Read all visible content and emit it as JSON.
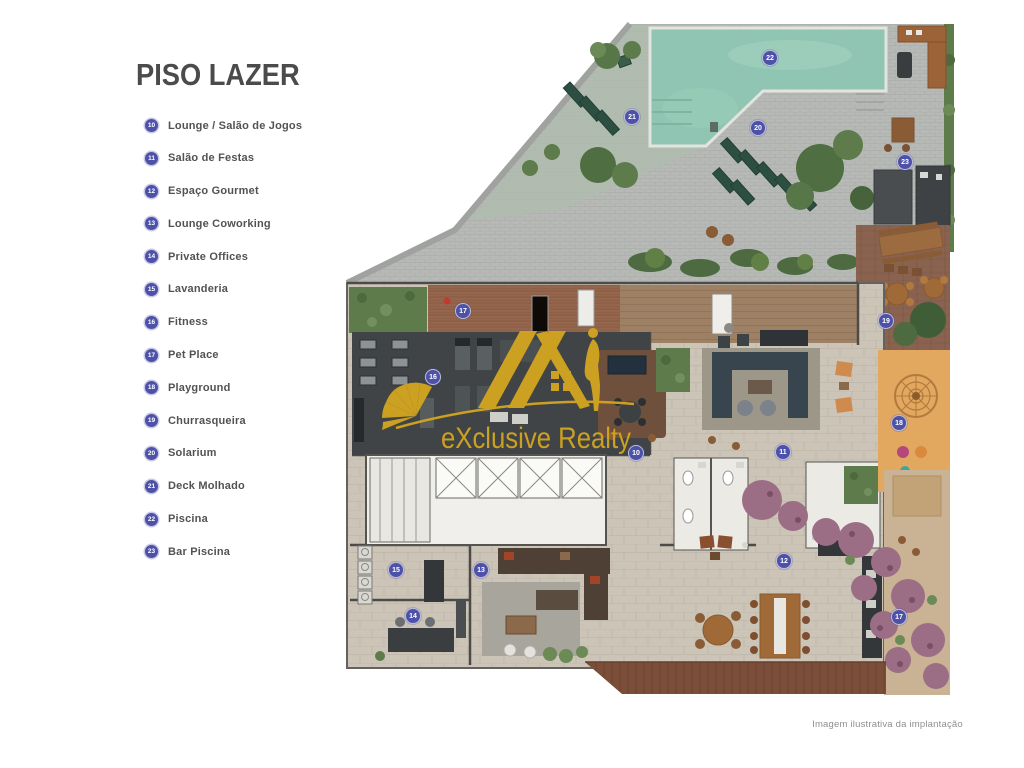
{
  "page": {
    "title": "PISO LAZER",
    "caption": "Imagem ilustrativa da implantação"
  },
  "watermark": {
    "brand": "eXclusive Realty"
  },
  "legend": {
    "items": [
      {
        "number": "10",
        "label": "Lounge / Salão de Jogos"
      },
      {
        "number": "11",
        "label": "Salão de Festas"
      },
      {
        "number": "12",
        "label": "Espaço Gourmet"
      },
      {
        "number": "13",
        "label": "Lounge Coworking"
      },
      {
        "number": "14",
        "label": "Private Offices"
      },
      {
        "number": "15",
        "label": "Lavanderia"
      },
      {
        "number": "16",
        "label": "Fitness"
      },
      {
        "number": "17",
        "label": "Pet Place"
      },
      {
        "number": "18",
        "label": "Playground"
      },
      {
        "number": "19",
        "label": "Churrasqueira"
      },
      {
        "number": "20",
        "label": "Solarium"
      },
      {
        "number": "21",
        "label": "Deck Molhado"
      },
      {
        "number": "22",
        "label": "Piscina"
      },
      {
        "number": "23",
        "label": "Bar Piscina"
      }
    ]
  },
  "plan": {
    "markers": [
      {
        "number": "22",
        "x": 770,
        "y": 58
      },
      {
        "number": "21",
        "x": 632,
        "y": 117
      },
      {
        "number": "20",
        "x": 758,
        "y": 128
      },
      {
        "number": "23",
        "x": 905,
        "y": 162
      },
      {
        "number": "17",
        "x": 463,
        "y": 311
      },
      {
        "number": "19",
        "x": 886,
        "y": 321
      },
      {
        "number": "16",
        "x": 433,
        "y": 377
      },
      {
        "number": "18",
        "x": 899,
        "y": 423
      },
      {
        "number": "10",
        "x": 636,
        "y": 453
      },
      {
        "number": "11",
        "x": 783,
        "y": 452
      },
      {
        "number": "12",
        "x": 784,
        "y": 561
      },
      {
        "number": "15",
        "x": 396,
        "y": 570
      },
      {
        "number": "13",
        "x": 481,
        "y": 570
      },
      {
        "number": "14",
        "x": 413,
        "y": 616
      },
      {
        "number": "17",
        "x": 899,
        "y": 617
      }
    ],
    "colors": {
      "marker": "#4d51a8",
      "watermark_gold": "#d2a41f",
      "pool": "#8fc5b2",
      "deck_pavers": "#b6b9b5",
      "playground": "#e3a85f",
      "building_floor": "#cbc4b7",
      "gym_floor": "#404446",
      "garden_purple": "#9b6e86"
    }
  }
}
